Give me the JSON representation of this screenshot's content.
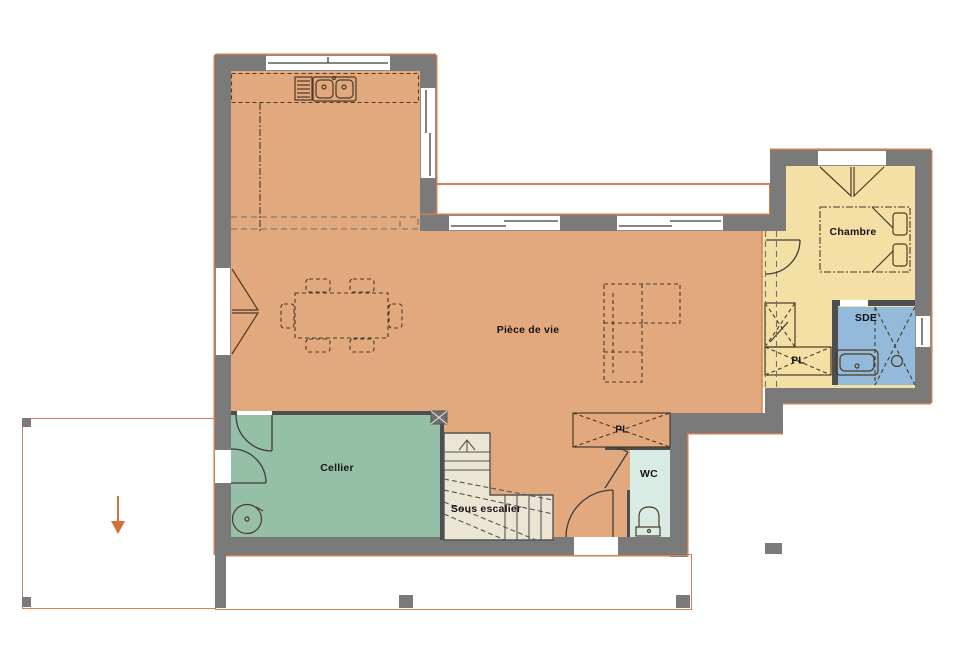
{
  "rooms": {
    "living": {
      "label": "Pièce de vie"
    },
    "bedroom": {
      "label": "Chambre"
    },
    "shower_room": {
      "label": "SDE"
    },
    "pantry": {
      "label": "Cellier"
    },
    "under_stairs": {
      "label": "Sous escalier"
    },
    "wc": {
      "label": "WC"
    },
    "closet_hall": {
      "label": "PL"
    },
    "closet_entry": {
      "label": "PL"
    }
  },
  "icons": {
    "entrance_arrow": "orange-down-arrow"
  },
  "colors": {
    "wall": "#7a7a7a",
    "living_floor": "#e2a87e",
    "bedroom_floor": "#f4dfa5",
    "shower_floor": "#93badb",
    "pantry_floor": "#95bfa6",
    "wc_floor": "#d9ece3",
    "stairs_floor": "#eae6d3",
    "outline": "#cb8250",
    "arrow": "#d2703a",
    "line": "#4b3a28"
  }
}
